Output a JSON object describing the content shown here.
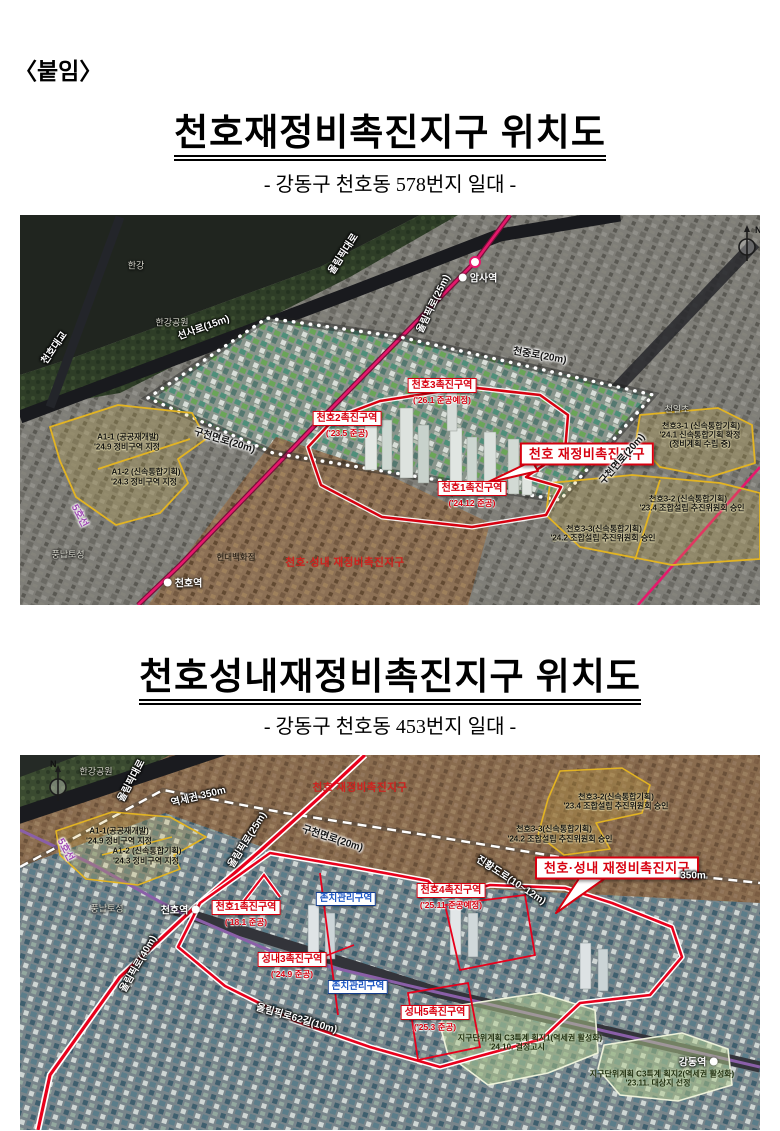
{
  "document": {
    "attachment_label": "〈붙임〉",
    "sections": [
      {
        "title": "천호재정비촉진지구 위치도",
        "subtitle": "- 강동구 천호동 578번지 일대 -"
      },
      {
        "title": "천호성내재정비촉진지구 위치도",
        "subtitle": "- 강동구 천호동 453번지 일대 -"
      }
    ]
  },
  "colors": {
    "zone_red": "#d7000f",
    "boundary_red": "#e8001c",
    "area_yellow": "#e3b422",
    "line8_pink": "#e6186c",
    "line5_purple": "#8a5fa8",
    "keep_zone_blue": "#123c8c",
    "green_area": "#b7cf8e"
  },
  "map1": {
    "compass_n": "N",
    "labels": [
      {
        "k": "place",
        "t": "한강",
        "x": 116,
        "y": 50,
        "n": "han-river-label"
      },
      {
        "k": "place",
        "t": "한강공원",
        "x": 152,
        "y": 107,
        "n": "han-river-park-label"
      },
      {
        "k": "roadw",
        "t": "천호대교",
        "x": 33,
        "y": 132,
        "r": -55,
        "n": "cheonho-bridge-label"
      },
      {
        "k": "roadw",
        "t": "올림픽대로",
        "x": 322,
        "y": 38,
        "r": -57,
        "n": "olympic-expressway-label"
      },
      {
        "k": "roadw",
        "t": "선사로(15m)",
        "x": 183,
        "y": 111,
        "r": -20,
        "n": "seonsa-ro-label"
      },
      {
        "k": "sta",
        "t": "암사역",
        "x": 458,
        "y": 62,
        "side": "l",
        "n": "amsa-station-label"
      },
      {
        "k": "roadw",
        "t": "올림픽로(25m)",
        "x": 412,
        "y": 88,
        "r": -64,
        "n": "olympic-ro-25m-label"
      },
      {
        "k": "roadd",
        "t": "천중로(20m)",
        "x": 520,
        "y": 139,
        "r": 10,
        "n": "cheonjung-ro-label"
      },
      {
        "k": "zr",
        "t": "천호3촉진구역",
        "s": "('26.1 준공예정)",
        "x": 422,
        "y": 177,
        "n": "cheonho3-zone-label"
      },
      {
        "k": "zr",
        "t": "천호2촉진구역",
        "s": "('23.5 준공)",
        "x": 327,
        "y": 210,
        "n": "cheonho2-zone-label"
      },
      {
        "k": "zr",
        "t": "천호1촉진구역",
        "s": "('24.12 준공)",
        "x": 452,
        "y": 280,
        "n": "cheonho1-zone-label"
      },
      {
        "k": "big",
        "t": "천호 재정비촉진지구",
        "x": 567,
        "y": 239,
        "n": "cheonho-district-callout"
      },
      {
        "k": "area",
        "t": "천호3-1 (신속통합기획)",
        "x": 681,
        "y": 211,
        "n": "cheonho3-1-note"
      },
      {
        "k": "area",
        "t": "'24.1 신속통합기획 확정",
        "x": 680,
        "y": 220,
        "n": "cheonho3-1-note2"
      },
      {
        "k": "area",
        "t": "(정비계획 수립 중)",
        "x": 680,
        "y": 229,
        "n": "cheonho3-1-note3"
      },
      {
        "k": "area",
        "t": "천호3-2 (신속통합기획)",
        "x": 668,
        "y": 284,
        "n": "cheonho3-2-note"
      },
      {
        "k": "area",
        "t": "'23.4 조합설립 추진위원회 승인",
        "x": 672,
        "y": 293,
        "n": "cheonho3-2-note2"
      },
      {
        "k": "area",
        "t": "천호3-3(신속통합기획)",
        "x": 584,
        "y": 314,
        "n": "cheonho3-3-note"
      },
      {
        "k": "area",
        "t": "'24.2 조합설립 추진위원회 승인",
        "x": 583,
        "y": 323,
        "n": "cheonho3-3-note2"
      },
      {
        "k": "roadd",
        "t": "구천면로(20m)",
        "x": 205,
        "y": 224,
        "r": 17,
        "n": "gucheonmyeon-ro-label-west"
      },
      {
        "k": "roadd",
        "t": "구천면로(20m)",
        "x": 601,
        "y": 243,
        "r": -49,
        "n": "gucheonmyeon-ro-label-east"
      },
      {
        "k": "area",
        "t": "A1-1 (공공재개발)",
        "x": 108,
        "y": 222,
        "n": "a1-1-note"
      },
      {
        "k": "area",
        "t": "'24.9 정비구역 지정",
        "x": 107,
        "y": 232,
        "n": "a1-1-note2"
      },
      {
        "k": "area",
        "t": "A1-2 (신속통합기획)",
        "x": 126,
        "y": 257,
        "n": "a1-2-note"
      },
      {
        "k": "area",
        "t": "'24.3 정비구역 지정",
        "x": 124,
        "y": 267,
        "n": "a1-2-note2"
      },
      {
        "k": "l5",
        "t": "5호선",
        "x": 61,
        "y": 300,
        "r": 62,
        "n": "line5-label"
      },
      {
        "k": "place",
        "t": "풍납토성",
        "x": 48,
        "y": 339,
        "n": "pungnap-toseong-label"
      },
      {
        "k": "sta",
        "t": "천호역",
        "x": 163,
        "y": 367,
        "side": "l",
        "n": "cheonho-station-label"
      },
      {
        "k": "placed",
        "t": "현대백화점",
        "x": 216,
        "y": 342,
        "n": "hyundai-dept-store-label"
      },
      {
        "k": "red",
        "t": "천호·성내 재정비촉진지구",
        "x": 325,
        "y": 347,
        "n": "cheonho-seongnae-district-text"
      },
      {
        "k": "place",
        "t": "천일초",
        "x": 657,
        "y": 194,
        "n": "cheonil-school-label"
      }
    ]
  },
  "map2": {
    "compass_n": "N",
    "labels": [
      {
        "k": "place",
        "t": "한강공원",
        "x": 76,
        "y": 16,
        "n": "han-river-park-label"
      },
      {
        "k": "roadw",
        "t": "올림픽대로",
        "x": 110,
        "y": 25,
        "r": -62,
        "n": "olympic-expressway-label"
      },
      {
        "k": "roadw",
        "t": "역세권 350m",
        "x": 178,
        "y": 40,
        "r": -14,
        "n": "station-area-350m-label"
      },
      {
        "k": "red",
        "t": "천호 재정비촉진지구",
        "x": 340,
        "y": 32,
        "n": "cheonho-district-text"
      },
      {
        "k": "area",
        "t": "A1-1(공공재개발)",
        "x": 99,
        "y": 76,
        "n": "a1-1-note"
      },
      {
        "k": "area",
        "t": "'24.9 정비구역 지정",
        "x": 99,
        "y": 86,
        "n": "a1-1-note2"
      },
      {
        "k": "area",
        "t": "A1-2 (신속통합기획)",
        "x": 127,
        "y": 96,
        "n": "a1-2-note"
      },
      {
        "k": "area",
        "t": "'24.3 정비구역 지정",
        "x": 126,
        "y": 106,
        "n": "a1-2-note2"
      },
      {
        "k": "l5",
        "t": "5호선",
        "x": 47,
        "y": 94,
        "r": 62,
        "n": "line5-label"
      },
      {
        "k": "area",
        "t": "천호3-2(신속통합기획)",
        "x": 596,
        "y": 42,
        "n": "cheonho3-2-note"
      },
      {
        "k": "area",
        "t": "'23.4 조합설립 추진위원회 승인",
        "x": 596,
        "y": 51,
        "n": "cheonho3-2-note2"
      },
      {
        "k": "area",
        "t": "천호3-3(신속통합기획)",
        "x": 534,
        "y": 74,
        "n": "cheonho3-3-note"
      },
      {
        "k": "area",
        "t": "'24.2 조합설립 추진위원회 승인",
        "x": 540,
        "y": 84,
        "n": "cheonho3-3-note2"
      },
      {
        "k": "roadw",
        "t": "올림픽로(25m)",
        "x": 226,
        "y": 84,
        "r": -58,
        "n": "olympic-ro-25m-label"
      },
      {
        "k": "roadd",
        "t": "구천면로(20m)",
        "x": 313,
        "y": 82,
        "r": 18,
        "n": "gucheonmyeon-ro-label"
      },
      {
        "k": "roadw",
        "t": "진황도로(10~12m)",
        "x": 492,
        "y": 124,
        "r": 33,
        "n": "jinhwang-doro-label"
      },
      {
        "k": "big",
        "t": "천호·성내 재정비촉진지구",
        "x": 597,
        "y": 113,
        "n": "cheonho-seongnae-callout"
      },
      {
        "k": "roadw",
        "t": "350m",
        "x": 673,
        "y": 121,
        "n": "dist-350m-label"
      },
      {
        "k": "place",
        "t": "풍납토성",
        "x": 87,
        "y": 153,
        "n": "pungnap-toseong-label"
      },
      {
        "k": "sta",
        "t": "천호역",
        "x": 160,
        "y": 154,
        "side": "r",
        "n": "cheonho-station-label"
      },
      {
        "k": "zr",
        "t": "천호1촉진구역",
        "s": "('18.1 준공)",
        "x": 226,
        "y": 159,
        "n": "cheonho1-zone-label"
      },
      {
        "k": "zb",
        "t": "존치관리구역",
        "x": 326,
        "y": 144,
        "n": "keep-mgmt-zone-label-1"
      },
      {
        "k": "zr",
        "t": "천호4촉진구역",
        "s": "('25.11 준공예정)",
        "x": 431,
        "y": 142,
        "n": "cheonho4-zone-label"
      },
      {
        "k": "zr",
        "t": "성내3촉진구역",
        "s": "('24.9 준공)",
        "x": 272,
        "y": 211,
        "n": "seongnae3-zone-label"
      },
      {
        "k": "zb",
        "t": "존치관리구역",
        "x": 338,
        "y": 232,
        "n": "keep-mgmt-zone-label-2"
      },
      {
        "k": "roadw",
        "t": "올림픽로(40m)",
        "x": 117,
        "y": 208,
        "r": -60,
        "n": "olympic-ro-40m-label"
      },
      {
        "k": "roadw",
        "t": "올림픽로62길(10m)",
        "x": 277,
        "y": 262,
        "r": 16,
        "n": "olympic-ro-62gil-label"
      },
      {
        "k": "zr",
        "t": "성내5촉진구역",
        "s": "('25.3 준공)",
        "x": 415,
        "y": 264,
        "n": "seongnae5-zone-label"
      },
      {
        "k": "areag",
        "t": "지구단위계획 C3특계 획지1(역세권 활성화)",
        "x": 510,
        "y": 283,
        "n": "c3-parcel1-note"
      },
      {
        "k": "areag",
        "t": "'24.10. 결정고시",
        "x": 497,
        "y": 292,
        "n": "c3-parcel1-note2"
      },
      {
        "k": "areag",
        "t": "지구단위계획 C3특계 획지2(역세권 활성화)",
        "x": 642,
        "y": 319,
        "n": "c3-parcel2-note"
      },
      {
        "k": "areag",
        "t": "'23.11. 대상지 선정",
        "x": 638,
        "y": 328,
        "n": "c3-parcel2-note2"
      },
      {
        "k": "sta",
        "t": "강동역",
        "x": 678,
        "y": 306,
        "side": "r",
        "n": "gangdong-station-label"
      }
    ]
  }
}
